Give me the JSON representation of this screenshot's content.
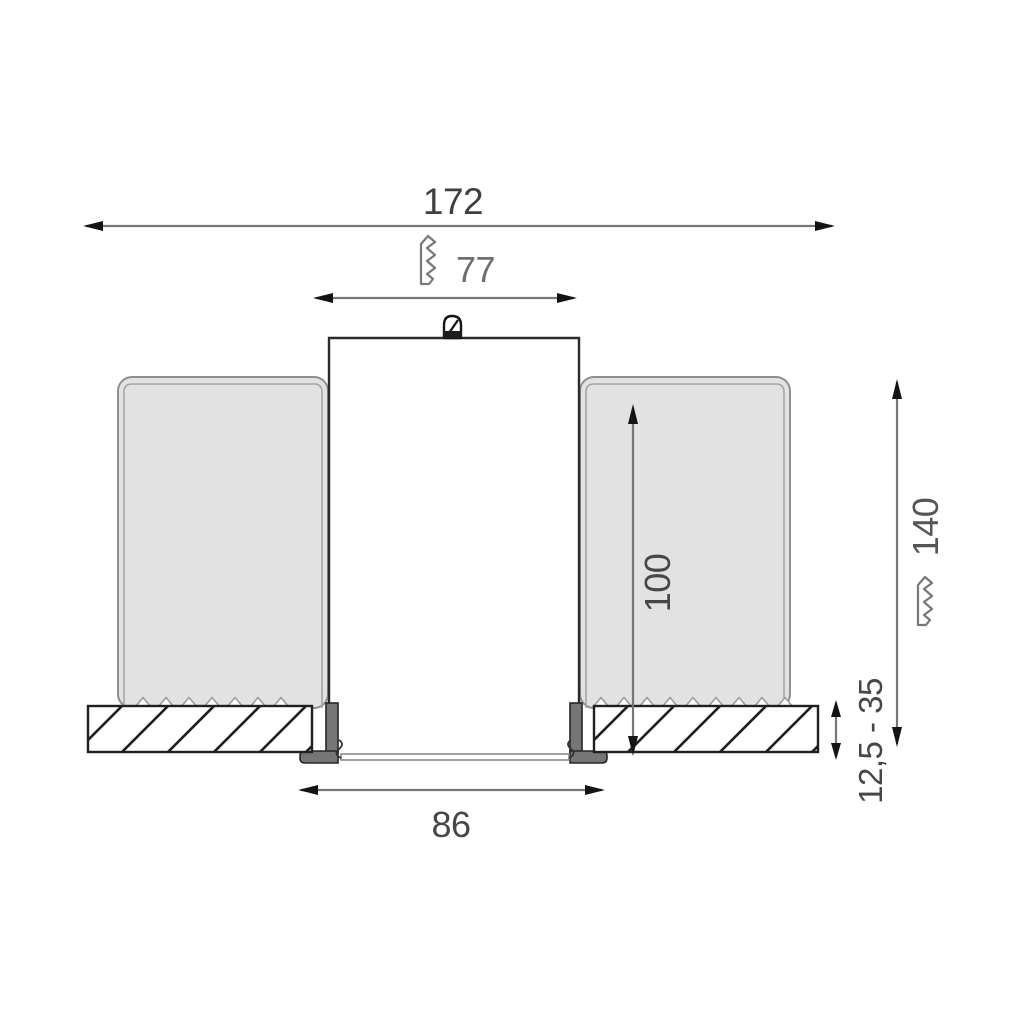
{
  "drawing": {
    "type": "technical-dimension-drawing",
    "subject": "recessed-downlight-ceiling-installation-cross-section",
    "dimensions": {
      "overall_width": "172",
      "housing_width": "77",
      "recess_depth": "100",
      "min_installation_depth": "140",
      "ceiling_thickness_range": "12,5 - 35",
      "cutout_width": "86"
    },
    "colors": {
      "background": "#ffffff",
      "spring_panel_fill": "#e2e2e2",
      "trim_flange_fill": "#767676",
      "outline": "#2b2b2b",
      "dimension_line": "#767676",
      "label_text": "#4a4a4a"
    },
    "icons": {
      "break_mark": "sawtooth-break-symbol",
      "clip": "mounting-clip-symbol"
    }
  }
}
